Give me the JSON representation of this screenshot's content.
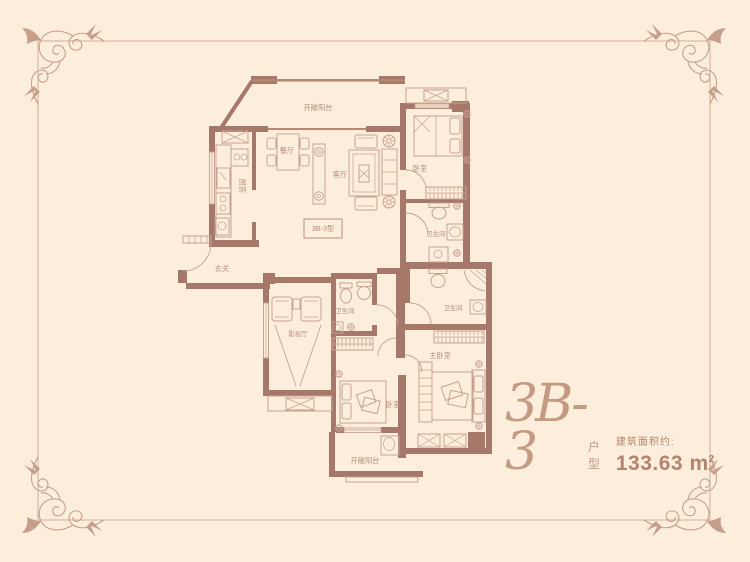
{
  "page": {
    "background_color": "#fdeedb",
    "frame_color": "#d3ae99"
  },
  "palette": {
    "wall": "#a5786a",
    "furniture_line": "#c8a190",
    "label_text": "#b98e7c",
    "title_text": "#c49a83",
    "area_text": "#b5836e"
  },
  "title": {
    "model": "3B-3",
    "model_suffix": "户型",
    "area_label": "建筑面积约:",
    "area_value": "133.63",
    "area_unit": "m",
    "area_exponent": "2"
  },
  "plan": {
    "unit_tag": "3B-3型",
    "rooms": {
      "balcony_top": "开敞阳台",
      "kitchen": "厨房",
      "dining": "餐厅",
      "living": "客厅",
      "entry": "玄关",
      "bedroom_top": "卧室",
      "bathroom_top": "卫生间",
      "media_room": "影视厅",
      "bathroom_mid": "卫生间",
      "bathroom_right": "卫生间",
      "master_bedroom": "主卧室",
      "bedroom_bottom": "卧室",
      "balcony_bottom": "开敞阳台"
    }
  }
}
